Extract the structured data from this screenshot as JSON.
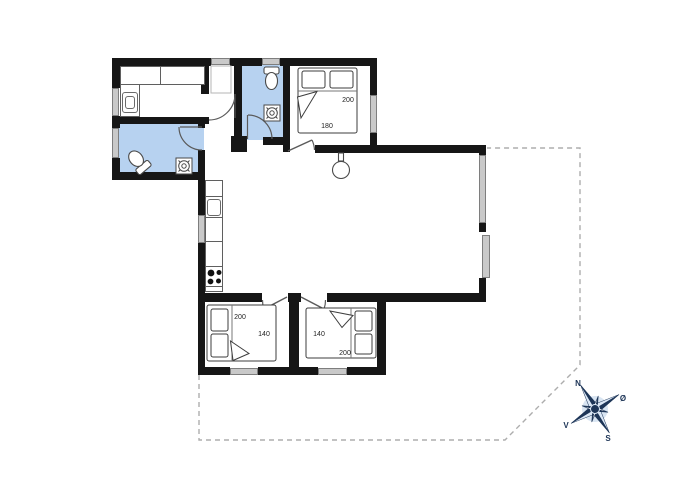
{
  "plan": {
    "type": "holiday-house-floor-plan",
    "colors": {
      "wall": "#161616",
      "bathroom_fill": "#b7d2f0",
      "window_gray": "#c9c9c9",
      "boundary_dash": "#adadad",
      "compass_navy": "#1d3557",
      "compass_light": "#dce8f6"
    },
    "fixtures": [
      "double-bed",
      "pillow",
      "toilet",
      "floor-drain",
      "hand-sink",
      "kitchen-sink",
      "stove-burners",
      "kitchen-counter",
      "utility-counter",
      "ceiling-lamp",
      "entrance-door",
      "interior-door-swing",
      "window",
      "terrace-boundary"
    ]
  },
  "rooms": {
    "bedroom_top": {
      "bed_length": "200",
      "bed_width": "180"
    },
    "bedroom_bottom_left": {
      "bed_length": "200",
      "bed_width": "140"
    },
    "bedroom_bottom_right": {
      "bed_length": "200",
      "bed_width": "140"
    }
  },
  "compass": {
    "north": "N",
    "east": "Ø",
    "south": "S",
    "west": "V"
  }
}
